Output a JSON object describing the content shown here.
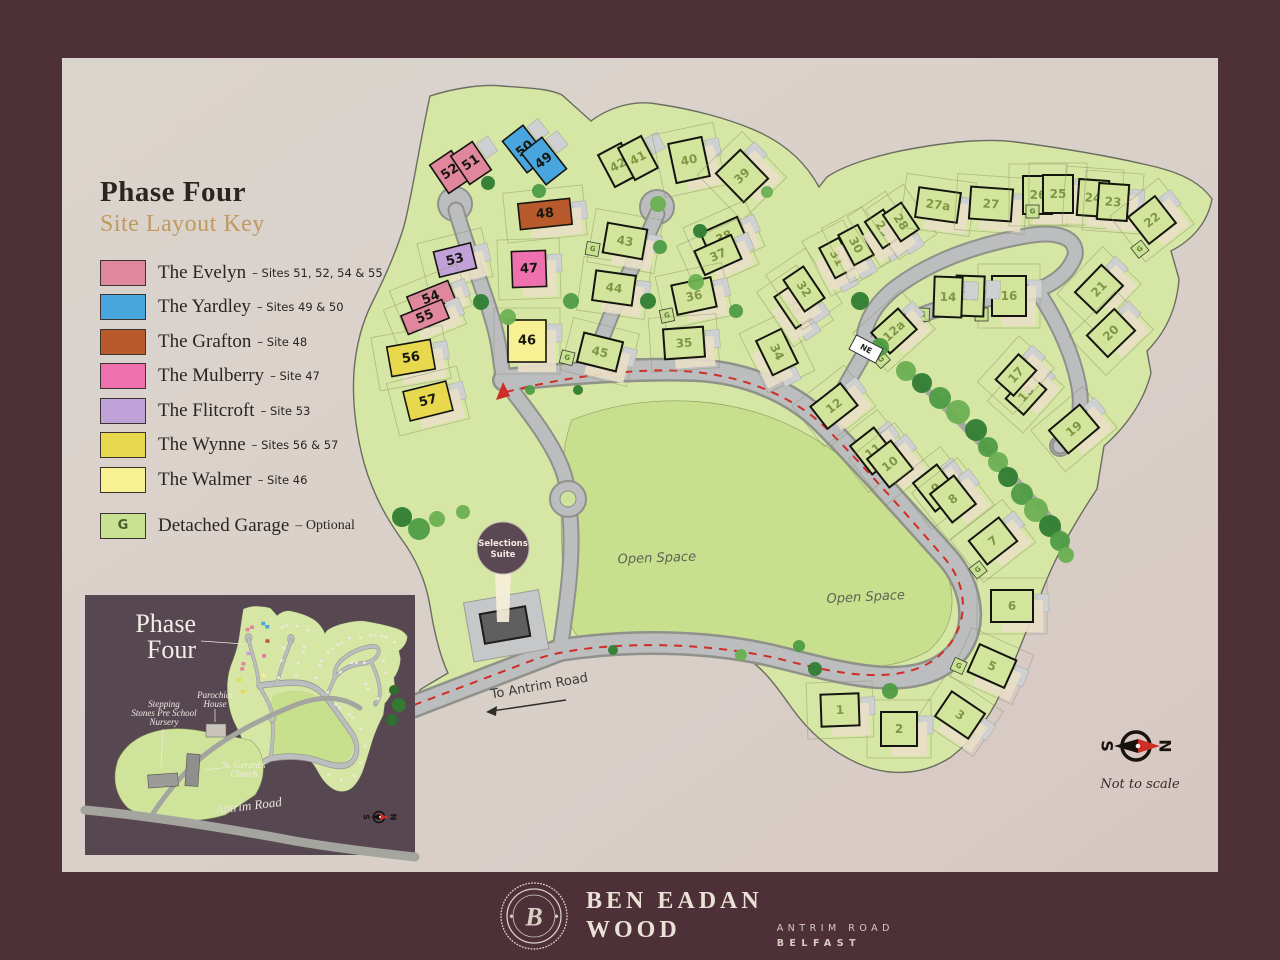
{
  "colors": {
    "brand_plum": "#4e3138",
    "panel": "#dad1ca",
    "gold": "#c0995d",
    "red_dash": "#cf2e26"
  },
  "legend": {
    "title": "Phase Four",
    "subtitle": "Site Layout Key",
    "items": [
      {
        "name": "The Evelyn",
        "sites": "– Sites 51, 52, 54 & 55",
        "color": "#e0879e"
      },
      {
        "name": "The Yardley",
        "sites": "– Sites 49 & 50",
        "color": "#48a5de"
      },
      {
        "name": "The Grafton",
        "sites": "– Site 48",
        "color": "#b85a2b"
      },
      {
        "name": "The Mulberry",
        "sites": "– Site 47",
        "color": "#ee70ae"
      },
      {
        "name": "The Flitcroft",
        "sites": "– Site 53",
        "color": "#c0a1d8"
      },
      {
        "name": "The Wynne",
        "sites": "– Sites 56 & 57",
        "color": "#e7d84e"
      },
      {
        "name": "The Walmer",
        "sites": "– Site 46",
        "color": "#f8f193"
      }
    ],
    "garage": {
      "label": "Detached Garage",
      "suffix": "– Optional",
      "letter": "G",
      "color": "#c9e193"
    }
  },
  "map": {
    "labels": {
      "open_space": "Open Space",
      "to_antrim_road": "To Antrim Road",
      "ne_sign": "NE",
      "selections_suite_1": "Selections",
      "selections_suite_2": "Suite"
    },
    "compass": {
      "south": "S",
      "north": "N",
      "note": "Not to scale"
    },
    "house_colors": {
      "evelyn": "#e0879e",
      "yardley": "#48a5de",
      "grafton": "#b85a2b",
      "mulberry": "#ee70ae",
      "flitcroft": "#c0a1d8",
      "wynne": "#e7d84e",
      "walmer": "#f8f193",
      "standard": "#d3e49c"
    },
    "plots": [
      {
        "n": "52",
        "x": 450,
        "y": 172,
        "r": -34,
        "w": 26,
        "h": 34,
        "t": "evelyn"
      },
      {
        "n": "51",
        "x": 471,
        "y": 163,
        "r": -34,
        "w": 26,
        "h": 34,
        "t": "evelyn"
      },
      {
        "n": "50",
        "x": 525,
        "y": 149,
        "r": -38,
        "w": 26,
        "h": 40,
        "t": "yardley"
      },
      {
        "n": "49",
        "x": 544,
        "y": 161,
        "r": -38,
        "w": 26,
        "h": 40,
        "t": "yardley"
      },
      {
        "n": "48",
        "x": 545,
        "y": 214,
        "r": -6,
        "w": 52,
        "h": 26,
        "t": "grafton"
      },
      {
        "n": "53",
        "x": 455,
        "y": 260,
        "r": -14,
        "w": 38,
        "h": 26,
        "t": "flitcroft"
      },
      {
        "n": "47",
        "x": 529,
        "y": 269,
        "r": -2,
        "w": 34,
        "h": 36,
        "t": "mulberry"
      },
      {
        "n": "54",
        "x": 431,
        "y": 298,
        "r": -22,
        "w": 44,
        "h": 20,
        "t": "evelyn"
      },
      {
        "n": "55",
        "x": 425,
        "y": 317,
        "r": -22,
        "w": 44,
        "h": 20,
        "t": "evelyn"
      },
      {
        "n": "56",
        "x": 411,
        "y": 358,
        "r": -10,
        "w": 44,
        "h": 30,
        "t": "wynne"
      },
      {
        "n": "57",
        "x": 428,
        "y": 401,
        "r": -14,
        "w": 44,
        "h": 30,
        "t": "wynne"
      },
      {
        "n": "46",
        "x": 527,
        "y": 341,
        "r": 0,
        "w": 38,
        "h": 42,
        "t": "walmer"
      },
      {
        "n": "45",
        "x": 600,
        "y": 352,
        "r": 14,
        "w": 40,
        "h": 30,
        "t": "standard",
        "g": 1
      },
      {
        "n": "44",
        "x": 614,
        "y": 288,
        "r": 8,
        "w": 40,
        "h": 30,
        "t": "standard"
      },
      {
        "n": "43",
        "x": 625,
        "y": 241,
        "r": 10,
        "w": 40,
        "h": 30,
        "t": "standard",
        "g": 1
      },
      {
        "n": "42",
        "x": 618,
        "y": 165,
        "r": -28,
        "w": 26,
        "h": 36,
        "t": "standard"
      },
      {
        "n": "41",
        "x": 638,
        "y": 158,
        "r": -28,
        "w": 26,
        "h": 36,
        "t": "standard"
      },
      {
        "n": "40",
        "x": 689,
        "y": 160,
        "r": -12,
        "w": 34,
        "h": 40,
        "t": "standard"
      },
      {
        "n": "39",
        "x": 742,
        "y": 176,
        "r": -44,
        "w": 34,
        "h": 40,
        "t": "standard"
      },
      {
        "n": "38",
        "x": 724,
        "y": 237,
        "r": -24,
        "w": 40,
        "h": 26,
        "t": "standard"
      },
      {
        "n": "37",
        "x": 718,
        "y": 255,
        "r": -24,
        "w": 40,
        "h": 26,
        "t": "standard"
      },
      {
        "n": "36",
        "x": 694,
        "y": 296,
        "r": -12,
        "w": 40,
        "h": 30,
        "t": "standard",
        "g": 1
      },
      {
        "n": "35",
        "x": 684,
        "y": 343,
        "r": -4,
        "w": 40,
        "h": 30,
        "t": "standard"
      },
      {
        "n": "34",
        "x": 777,
        "y": 352,
        "r": 64,
        "w": 38,
        "h": 28,
        "t": "standard"
      },
      {
        "n": "33",
        "x": 795,
        "y": 306,
        "r": 56,
        "w": 38,
        "h": 24,
        "t": "standard"
      },
      {
        "n": "32",
        "x": 804,
        "y": 289,
        "r": 56,
        "w": 38,
        "h": 24,
        "t": "standard"
      },
      {
        "n": "31",
        "x": 837,
        "y": 258,
        "r": 62,
        "w": 34,
        "h": 22,
        "t": "standard"
      },
      {
        "n": "30",
        "x": 856,
        "y": 245,
        "r": 62,
        "w": 34,
        "h": 22,
        "t": "standard"
      },
      {
        "n": "29",
        "x": 883,
        "y": 229,
        "r": 56,
        "w": 32,
        "h": 22,
        "t": "standard"
      },
      {
        "n": "28",
        "x": 901,
        "y": 222,
        "r": 56,
        "w": 32,
        "h": 22,
        "t": "standard"
      },
      {
        "n": "27a",
        "x": 938,
        "y": 205,
        "r": 8,
        "w": 42,
        "h": 30,
        "t": "standard"
      },
      {
        "n": "27",
        "x": 991,
        "y": 204,
        "r": 4,
        "w": 42,
        "h": 32,
        "t": "standard"
      },
      {
        "n": "26",
        "x": 1038,
        "y": 195,
        "r": 0,
        "w": 30,
        "h": 38,
        "t": "standard"
      },
      {
        "n": "25",
        "x": 1058,
        "y": 194,
        "r": 0,
        "w": 30,
        "h": 38,
        "t": "standard",
        "g": 1
      },
      {
        "n": "24",
        "x": 1093,
        "y": 198,
        "r": 4,
        "w": 30,
        "h": 36,
        "t": "standard"
      },
      {
        "n": "23",
        "x": 1113,
        "y": 202,
        "r": 4,
        "w": 30,
        "h": 36,
        "t": "standard"
      },
      {
        "n": "22",
        "x": 1152,
        "y": 220,
        "r": -38,
        "w": 34,
        "h": 34,
        "t": "standard",
        "g": 1
      },
      {
        "n": "21",
        "x": 1099,
        "y": 289,
        "r": -46,
        "w": 38,
        "h": 30,
        "t": "standard"
      },
      {
        "n": "20",
        "x": 1111,
        "y": 333,
        "r": -44,
        "w": 38,
        "h": 30,
        "t": "standard"
      },
      {
        "n": "19",
        "x": 1074,
        "y": 429,
        "r": -40,
        "w": 40,
        "h": 30,
        "t": "standard"
      },
      {
        "n": "18",
        "x": 1026,
        "y": 394,
        "r": -48,
        "w": 34,
        "h": 24,
        "t": "standard"
      },
      {
        "n": "17",
        "x": 1016,
        "y": 375,
        "r": -48,
        "w": 34,
        "h": 24,
        "t": "standard"
      },
      {
        "n": "16",
        "x": 1009,
        "y": 296,
        "r": 0,
        "w": 34,
        "h": 40,
        "t": "standard",
        "g": 1
      },
      {
        "n": "15",
        "x": 970,
        "y": 296,
        "r": 2,
        "w": 28,
        "h": 40,
        "t": "standard"
      },
      {
        "n": "14",
        "x": 948,
        "y": 297,
        "r": 2,
        "w": 28,
        "h": 40,
        "t": "standard",
        "g": 1
      },
      {
        "n": "12a",
        "x": 894,
        "y": 331,
        "r": -42,
        "w": 36,
        "h": 28,
        "t": "standard",
        "g": 1
      },
      {
        "n": "12",
        "x": 834,
        "y": 406,
        "r": -38,
        "w": 38,
        "h": 28,
        "t": "standard"
      },
      {
        "n": "11",
        "x": 873,
        "y": 451,
        "r": -38,
        "w": 30,
        "h": 36,
        "t": "standard"
      },
      {
        "n": "10",
        "x": 890,
        "y": 464,
        "r": -38,
        "w": 30,
        "h": 36,
        "t": "standard"
      },
      {
        "n": "9",
        "x": 936,
        "y": 488,
        "r": -38,
        "w": 30,
        "h": 36,
        "t": "standard"
      },
      {
        "n": "8",
        "x": 953,
        "y": 499,
        "r": -38,
        "w": 30,
        "h": 36,
        "t": "standard"
      },
      {
        "n": "7",
        "x": 993,
        "y": 541,
        "r": -38,
        "w": 38,
        "h": 30,
        "t": "standard",
        "g": 1
      },
      {
        "n": "6",
        "x": 1012,
        "y": 606,
        "r": 0,
        "w": 42,
        "h": 32,
        "t": "standard"
      },
      {
        "n": "5",
        "x": 992,
        "y": 666,
        "r": 24,
        "w": 40,
        "h": 30,
        "t": "standard",
        "g": 1
      },
      {
        "n": "3",
        "x": 960,
        "y": 715,
        "r": 34,
        "w": 40,
        "h": 30,
        "t": "standard"
      },
      {
        "n": "2",
        "x": 899,
        "y": 729,
        "r": 0,
        "w": 36,
        "h": 34,
        "t": "standard"
      },
      {
        "n": "1",
        "x": 840,
        "y": 710,
        "r": -2,
        "w": 38,
        "h": 32,
        "t": "standard"
      }
    ]
  },
  "inset": {
    "title_line1": "Phase",
    "title_line2": "Four",
    "labels": {
      "nursery": [
        "Stepping",
        "Stones Pre School",
        "Nursery"
      ],
      "parochial": [
        "Parochial",
        "House"
      ],
      "church": [
        "St. Gerard's",
        "Church"
      ],
      "road": "Antrim Road"
    },
    "compass": {
      "south": "S",
      "north": "N"
    }
  },
  "footer": {
    "monogram": "B",
    "brand_line1": "BEN EADAN",
    "brand_line2": "WOOD",
    "sub_line1": "ANTRIM ROAD",
    "sub_line2": "BELFAST"
  }
}
